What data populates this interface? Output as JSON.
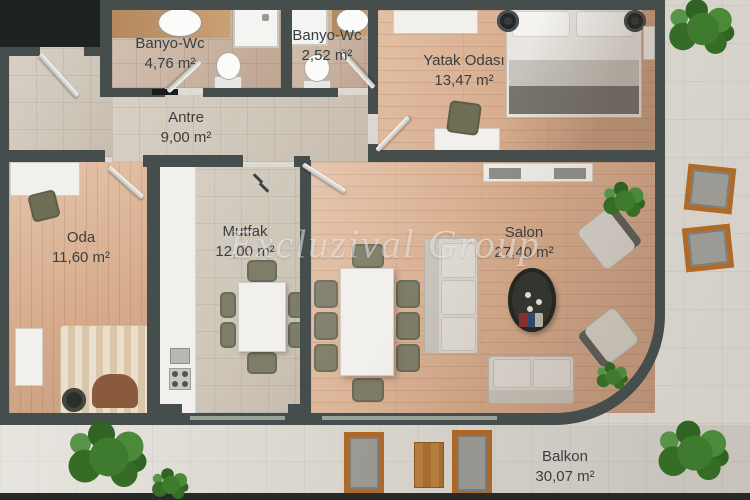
{
  "watermark": "Excluzival Group",
  "rooms": [
    {
      "name": "Banyo-Wc",
      "area": "4,76 m²"
    },
    {
      "name": "Banyo-Wc",
      "area": "2,52 m²"
    },
    {
      "name": "Yatak Odası",
      "area": "13,47 m²"
    },
    {
      "name": "Antre",
      "area": "9,00 m²"
    },
    {
      "name": "Oda",
      "area": "11,60 m²"
    },
    {
      "name": "Mutfak",
      "area": "12,00 m²"
    },
    {
      "name": "Salon",
      "area": "27,40 m²"
    },
    {
      "name": "Balkon",
      "area": "30,07 m²"
    }
  ],
  "colors": {
    "wall": "#454d4d",
    "void": "#1f2222",
    "tile": "#cfc6ba",
    "bath_tile": "#c9b3a2",
    "wood": "#d6ab8c",
    "paving": "#dbd7cf",
    "label_text": "#3a4041",
    "watermark_color": "rgba(250,250,250,0.52)",
    "accent_wood": "#b06a28",
    "cushion_gray": "#9c9a94",
    "olive_chair": "#7d7d68",
    "white_furniture": "#f1f0ec",
    "greenery": "#3e7b2f"
  }
}
